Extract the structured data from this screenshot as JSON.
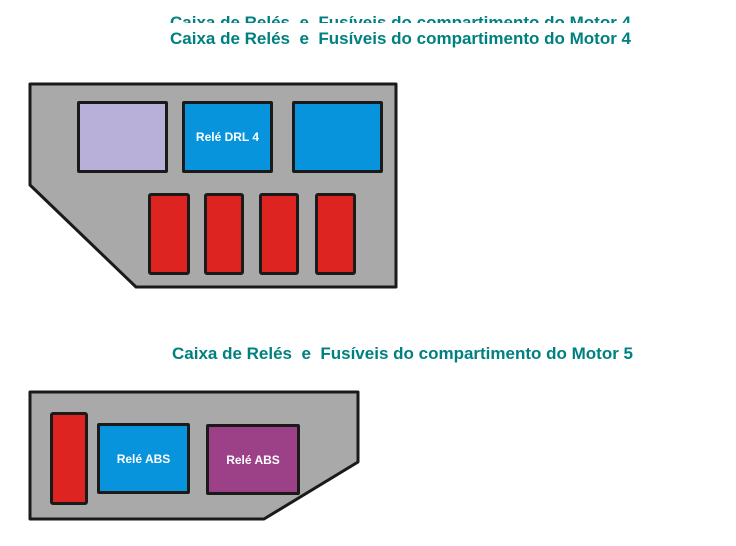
{
  "page": {
    "background": "#ffffff"
  },
  "colors": {
    "title_text": "#008080",
    "box_fill": "#a9a9a9",
    "outline": "#1a1a1a",
    "relay_blue": "#0894dc",
    "fuse_red": "#dd2420",
    "relay_lavender": "#b8b0d8",
    "relay_purple": "#9c4188",
    "relay_label_text": "#ffffff"
  },
  "titles": {
    "motor4_ghost": "Caixa de Relés  e  Fusíveis do compartimento do Motor 4",
    "motor4": "Caixa de Relés  e  Fusíveis do compartimento do Motor 4",
    "motor5": "Caixa de Relés  e  Fusíveis do compartimento do Motor 5"
  },
  "boxes": {
    "motor4": {
      "relay_lavender_label": "",
      "relay_drl_label": "Relé DRL 4",
      "relay_blue_unlabeled_label": "",
      "fuse_count": 4
    },
    "motor5": {
      "fuse_count": 1,
      "relay_abs_blue_label": "Relé ABS",
      "relay_abs_purple_label": "Relé ABS"
    }
  }
}
